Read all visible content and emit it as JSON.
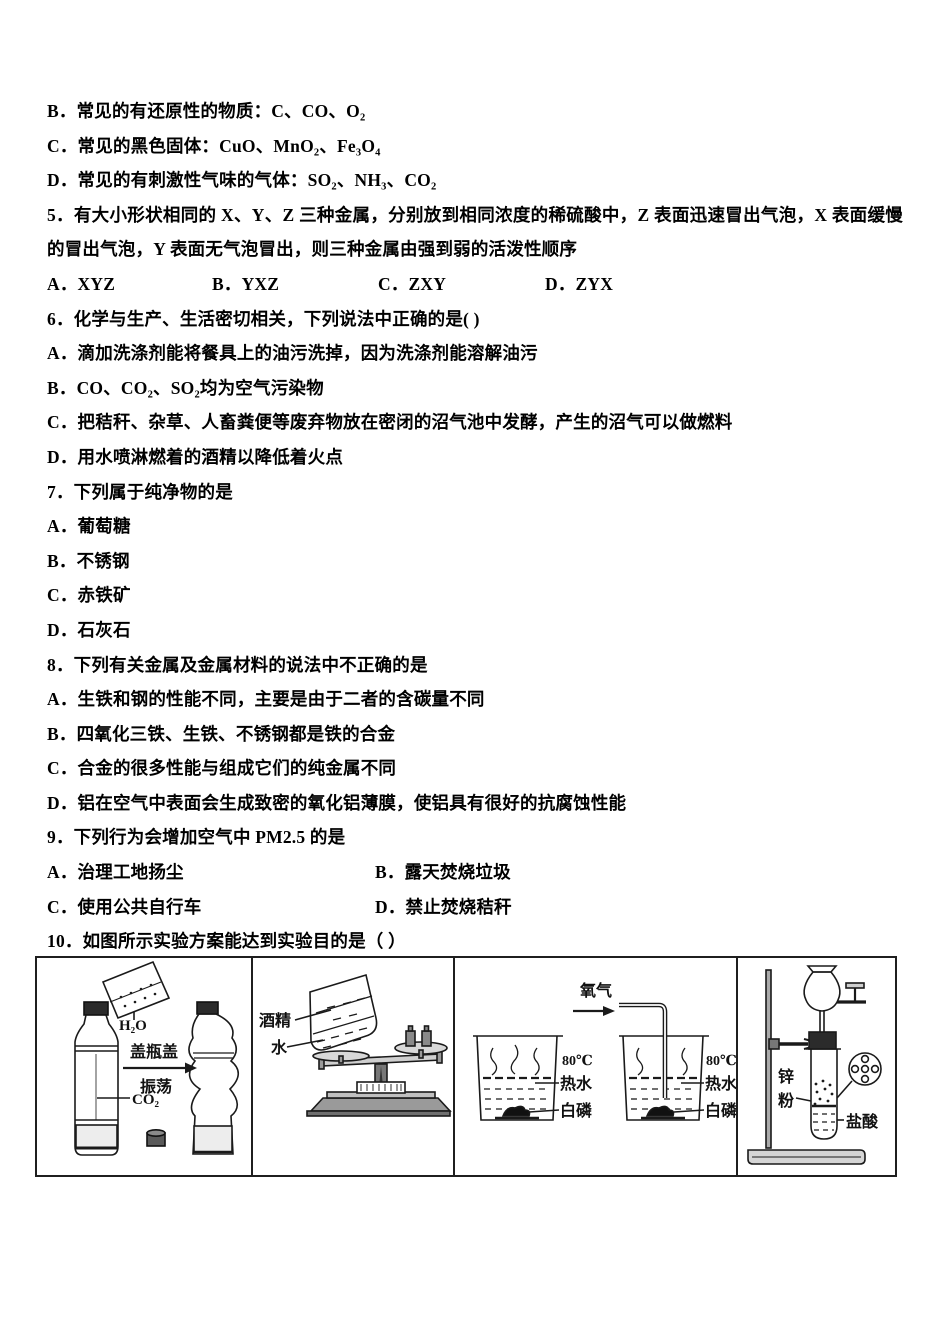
{
  "colors": {
    "page_bg": "#ffffff",
    "ink": "#000000",
    "line_art": "#1a1a1a"
  },
  "exam": {
    "q4_tail_options": [
      "B．常见的有还原性的物质：C、CO、O₂",
      "C．常见的黑色固体：CuO、MnO₂、Fe₃O₄",
      "D．常见的有刺激性气味的气体：SO₂、NH₃、CO₂"
    ],
    "q5": {
      "stem": "5．有大小形状相同的 X、Y、Z 三种金属，分别放到相同浓度的稀硫酸中，Z 表面迅速冒出气泡，X 表面缓慢的冒出气泡，Y 表面无气泡冒出，则三种金属由强到弱的活泼性顺序",
      "options": [
        "A．XYZ",
        "B．YXZ",
        "C．ZXY",
        "D．ZYX"
      ]
    },
    "q6": {
      "stem": "6．化学与生产、生活密切相关，下列说法中正确的是( )",
      "options": [
        "A．滴加洗涤剂能将餐具上的油污洗掉，因为洗涤剂能溶解油污",
        "B．CO、CO₂、SO₂均为空气污染物",
        "C．把秸秆、杂草、人畜粪便等废弃物放在密闭的沼气池中发酵，产生的沼气可以做燃料",
        "D．用水喷淋燃着的酒精以降低着火点"
      ]
    },
    "q7": {
      "stem": "7．下列属于纯净物的是",
      "options": [
        "A．葡萄糖",
        "B．不锈钢",
        "C．赤铁矿",
        "D．石灰石"
      ]
    },
    "q8": {
      "stem": "8．下列有关金属及金属材料的说法中不正确的是",
      "options": [
        "A．生铁和钢的性能不同，主要是由于二者的含碳量不同",
        "B．四氧化三铁、生铁、不锈钢都是铁的合金",
        "C．合金的很多性能与组成它们的纯金属不同",
        "D．铝在空气中表面会生成致密的氧化铝薄膜，使铝具有很好的抗腐蚀性能"
      ]
    },
    "q9": {
      "stem": "9．下列行为会增加空气中 PM2.5 的是",
      "options": [
        "A．治理工地扬尘",
        "B．露天焚烧垃圾",
        "C．使用公共自行车",
        "D．禁止焚烧秸秆"
      ]
    },
    "q10": {
      "stem": "10．如图所示实验方案能达到实验目的是（ ）"
    },
    "q10_figure": {
      "panel_a": {
        "pour_liquid": "H₂O",
        "step_top": "盖瓶盖",
        "step_bottom": "振荡",
        "gas": "CO₂"
      },
      "panel_b": {
        "liquid_top": "酒精",
        "liquid_bottom": "水"
      },
      "panel_c": {
        "gas": "氧气",
        "temperature": "80℃",
        "hot_water": "热水",
        "white_phosphorus": "白磷"
      },
      "panel_d": {
        "zinc_line1": "锌",
        "zinc_line2": "粉",
        "acid": "盐酸"
      }
    }
  }
}
